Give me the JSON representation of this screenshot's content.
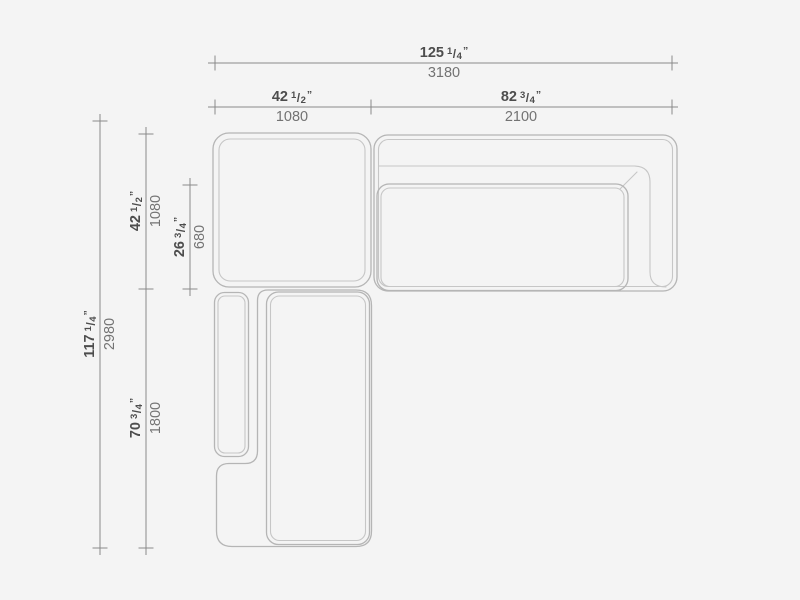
{
  "drawing": {
    "name": "sectional-sofa-plan-drawing",
    "background_color": "#f4f4f4",
    "dimension_line_color": "#8a8a8a",
    "sofa_outline_color": "#b5b5b5",
    "sofa_inner_line_color": "#c6c6c6",
    "inch_text_color": "#4d4d4d",
    "mm_text_color": "#737373"
  },
  "marks": {
    "slash": "/",
    "inch": "”"
  },
  "dimensions": {
    "total_width": {
      "whole": "125",
      "num": "1",
      "den": "4",
      "mm": "3180"
    },
    "corner_width": {
      "whole": "42",
      "num": "1",
      "den": "2",
      "mm": "1080"
    },
    "sofa_width": {
      "whole": "82",
      "num": "3",
      "den": "4",
      "mm": "2100"
    },
    "total_depth": {
      "whole": "117",
      "num": "1",
      "den": "4",
      "mm": "2980"
    },
    "corner_depth": {
      "whole": "42",
      "num": "1",
      "den": "2",
      "mm": "1080"
    },
    "seat_depth": {
      "whole": "26",
      "num": "3",
      "den": "4",
      "mm": "680"
    },
    "chaise_depth": {
      "whole": "70",
      "num": "3",
      "den": "4",
      "mm": "1800"
    }
  }
}
